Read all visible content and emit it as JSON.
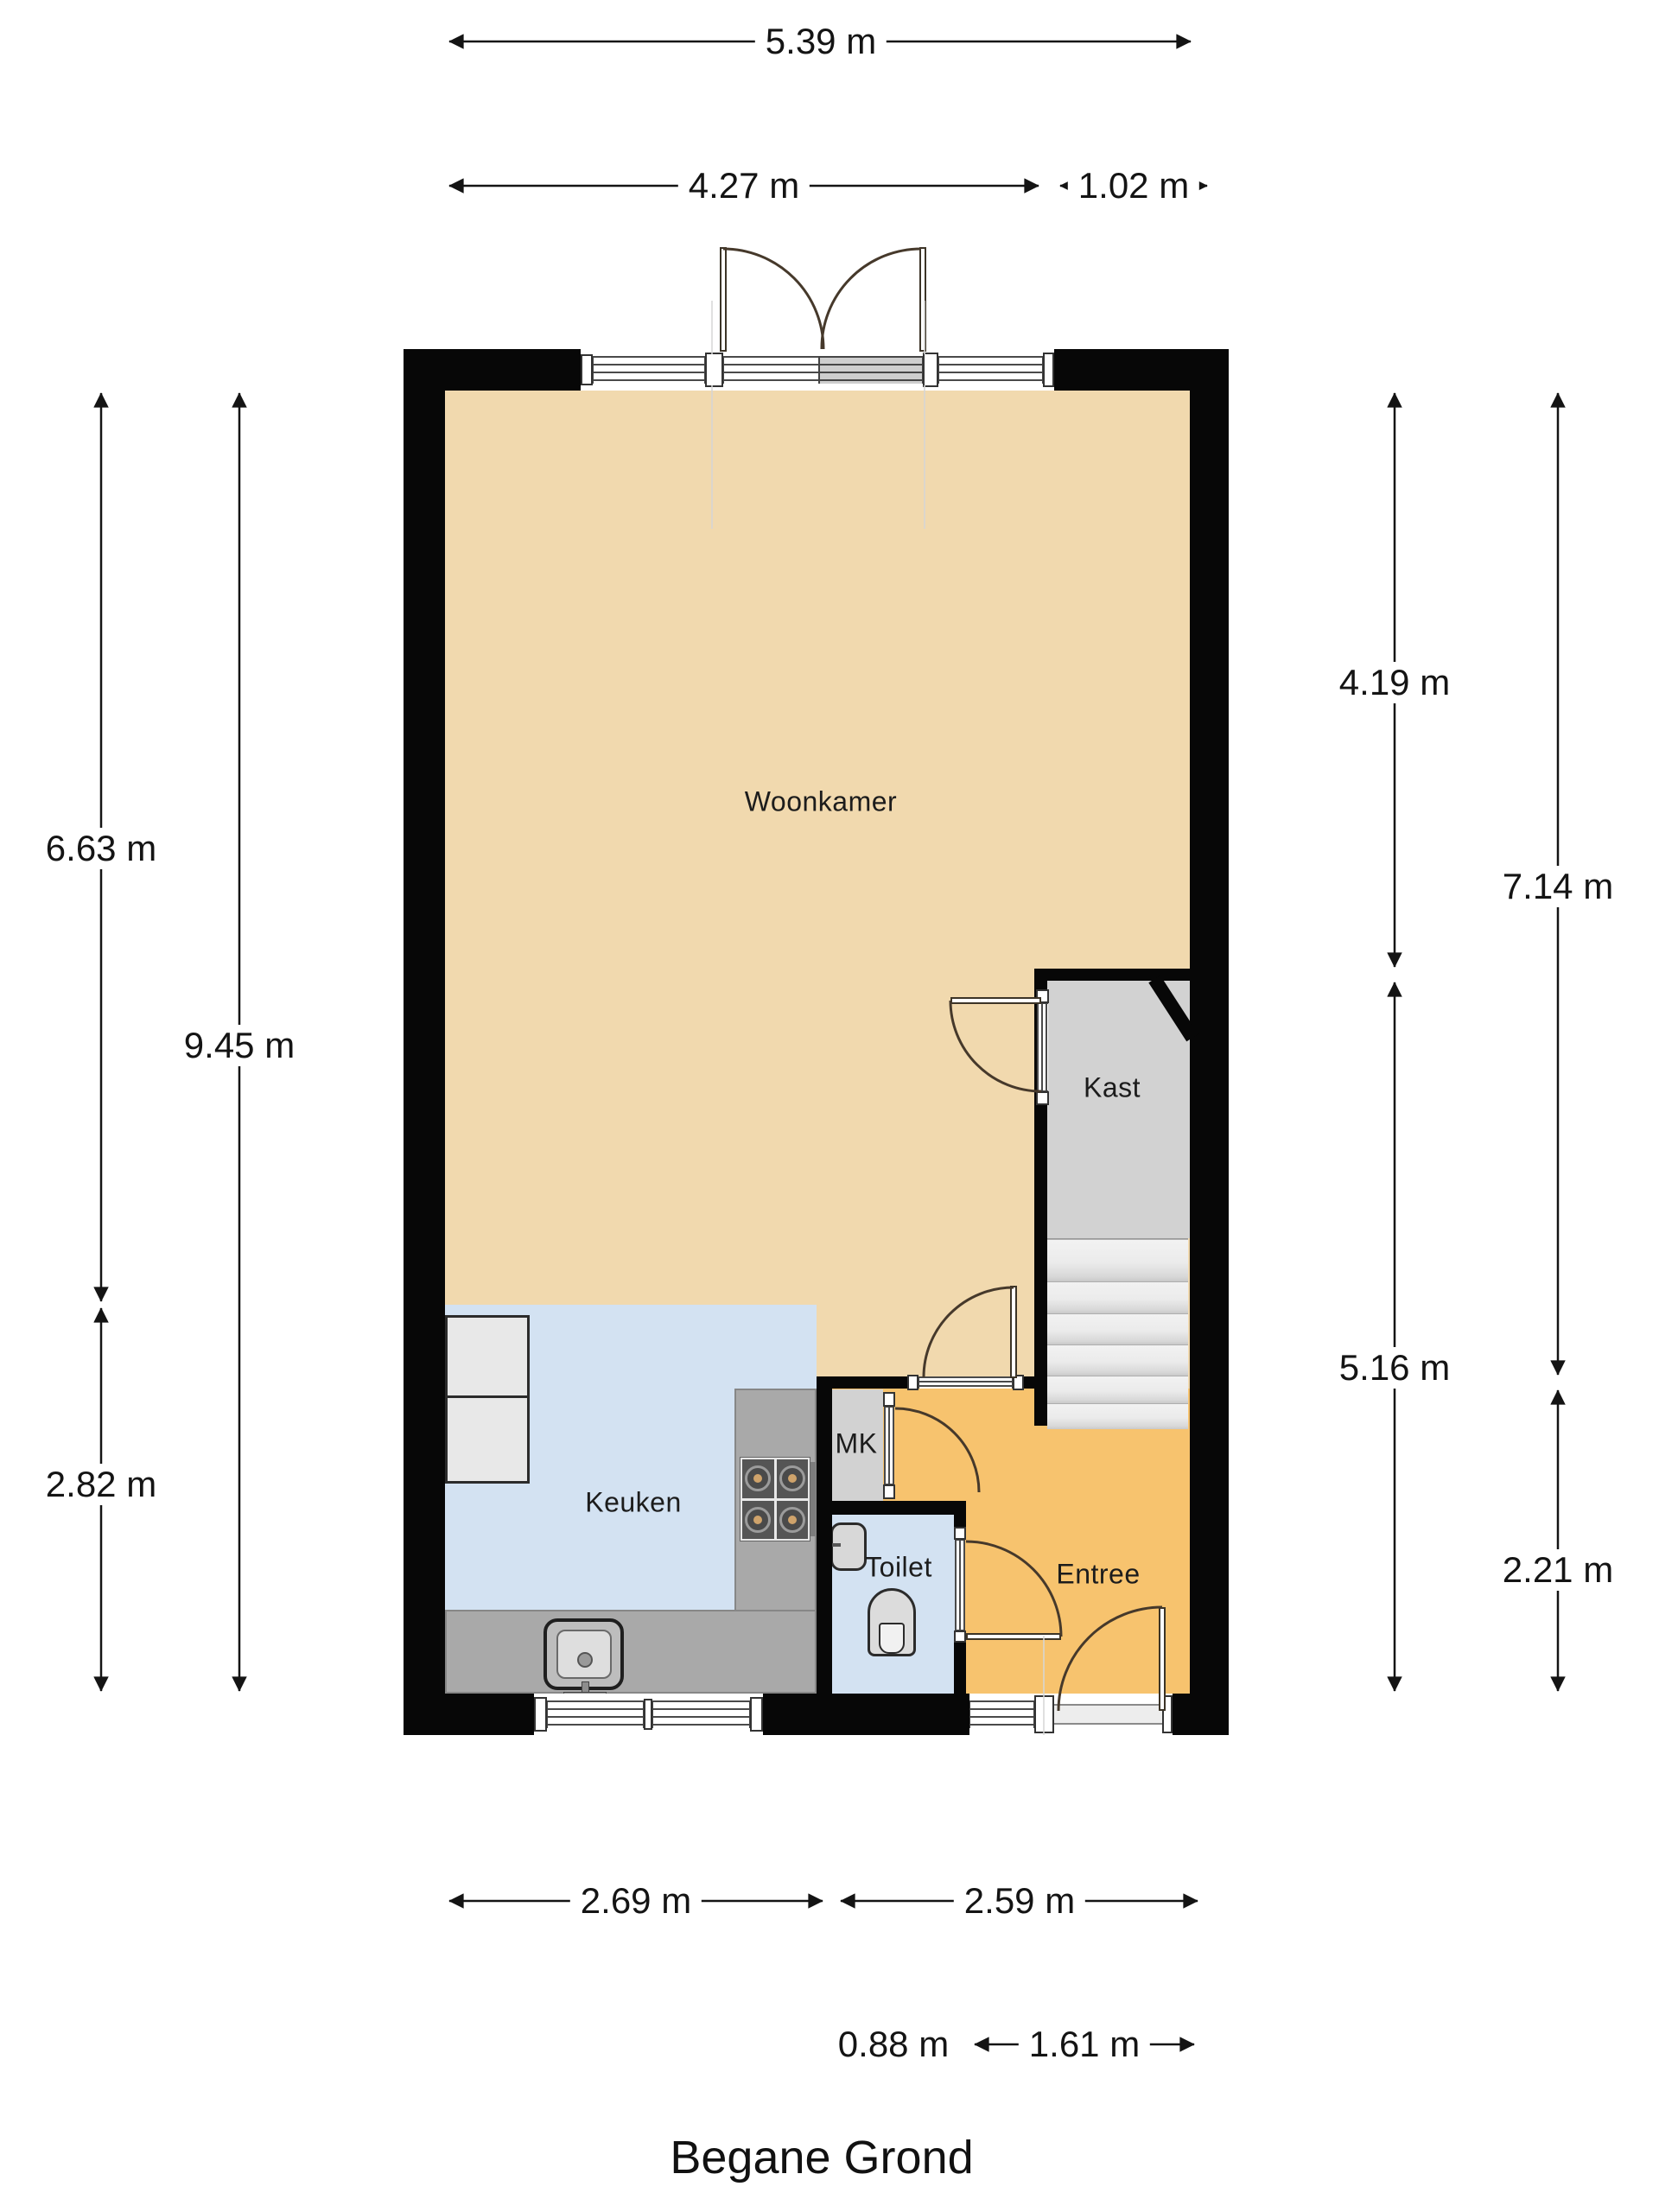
{
  "title": "Begane Grond",
  "rooms": {
    "livingroom": "Woonkamer",
    "closet": "Kast",
    "kitchen": "Keuken",
    "meter_cupboard": "MK",
    "toilet": "Toilet",
    "entry": "Entree"
  },
  "dimensions": {
    "top_total": "5.39 m",
    "top_main": "4.27 m",
    "top_side": "1.02 m",
    "left_upper": "6.63 m",
    "left_lower": "2.82 m",
    "left_total": "9.45 m",
    "right_inner_upper": "4.19 m",
    "right_inner_lower": "5.16 m",
    "right_outer_upper": "7.14 m",
    "right_outer_lower": "2.21 m",
    "bottom_kitchen": "2.69 m",
    "bottom_entry": "2.59 m",
    "bottom_wall": "0.88 m",
    "bottom_door": "1.61 m"
  },
  "colors": {
    "wall": "#070707",
    "living": "#f1d9ae",
    "entry": "#f7c36e",
    "kitchen": "#d3e2f2",
    "closet": "#d2d2d2",
    "counter": "#a9a9a9",
    "stairs": "#ececec",
    "dimension": "#141414",
    "door_swing": "#46392b"
  }
}
